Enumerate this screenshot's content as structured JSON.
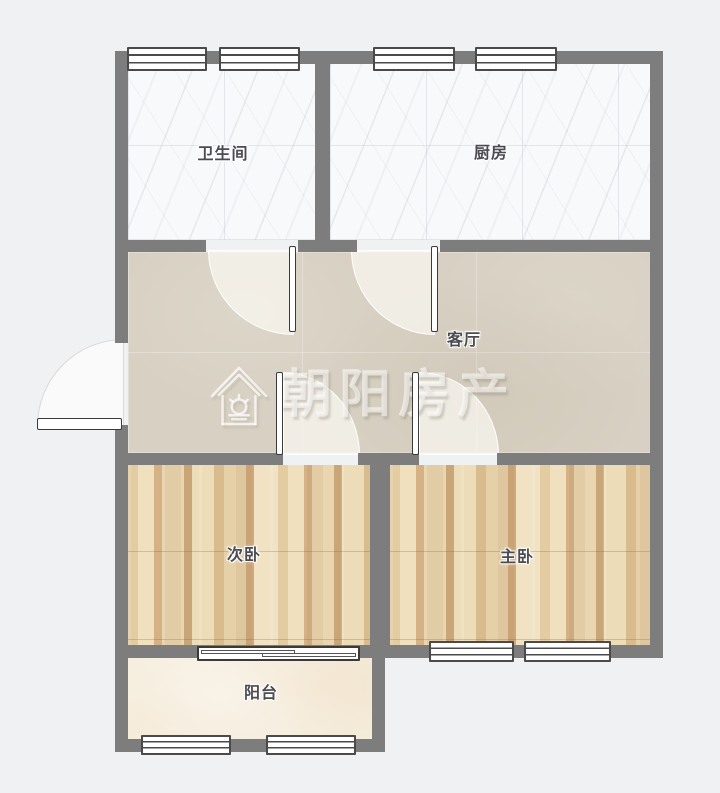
{
  "watermark": {
    "brand": "朝阳房产",
    "icon": "house-sun-logo"
  },
  "rooms": [
    {
      "name": "bathroom",
      "label": "卫生间",
      "floor": "marble-tile"
    },
    {
      "name": "kitchen",
      "label": "厨房",
      "floor": "marble-tile"
    },
    {
      "name": "living-room",
      "label": "客厅",
      "floor": "ceramic-tile"
    },
    {
      "name": "second-bedroom",
      "label": "次卧",
      "floor": "wood-plank"
    },
    {
      "name": "master-bedroom",
      "label": "主卧",
      "floor": "wood-plank"
    },
    {
      "name": "balcony",
      "label": "阳台",
      "floor": "cream-tile"
    }
  ],
  "openings": {
    "window_count": 8,
    "swing_door_count": 5,
    "sliding_door_count": 1
  },
  "colors": {
    "background": "#eff1f3",
    "wall": "#7d7d7d",
    "marble_floor": "#f8f9fb",
    "living_floor": "#d8d1c3",
    "wood_floor": "#e7d3ac",
    "balcony_floor": "#f5eddc",
    "label_text": "#4b4b52",
    "watermark": "rgba(255,255,255,0.55)"
  }
}
